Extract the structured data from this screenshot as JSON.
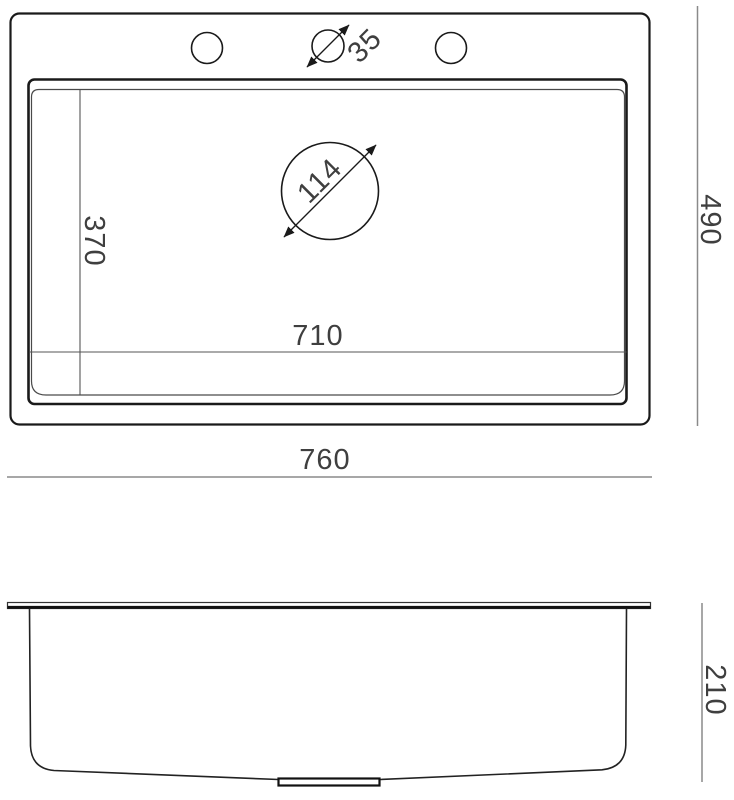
{
  "drawing": {
    "type": "sink-technical-dimension-drawing",
    "top_view": {
      "overall_width_label": "760",
      "overall_depth_label": "490",
      "inner_length_label": "710",
      "inner_depth_label": "370",
      "drain_diameter_label": "114",
      "faucet_hole_diameter_label": "35"
    },
    "side_view": {
      "height_label": "210"
    },
    "colors": {
      "outline": "#1a1a1a",
      "thin_line": "#4a4a4a",
      "dimension_line": "#8a8a8a",
      "text": "#3f3f3f",
      "background": "#ffffff"
    }
  }
}
